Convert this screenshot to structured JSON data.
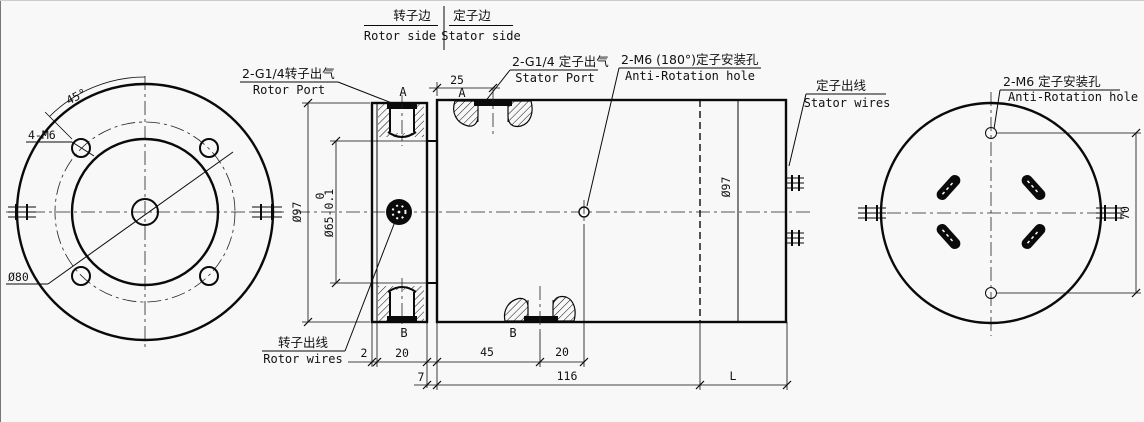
{
  "header": {
    "rotor_side_cn": "转子边",
    "rotor_side_en": "Rotor side",
    "stator_side_cn": "定子边",
    "stator_side_en": "Stator side"
  },
  "labels": {
    "rotor_port_cn": "2-G1/4转子出气",
    "rotor_port_en": "Rotor Port",
    "stator_port_cn": "2-G1/4 定子出气",
    "stator_port_en": "Stator Port",
    "anti_rotation_mid_cn": "2-M6 (180°)定子安装孔",
    "anti_rotation_mid_en": "Anti-Rotation hole",
    "stator_wires_cn": "定子出线",
    "stator_wires_en": "Stator wires",
    "anti_rotation_right_cn": "2-M6 定子安装孔",
    "anti_rotation_right_en": "Anti-Rotation hole",
    "rotor_wires_cn": "转子出线",
    "rotor_wires_en": "Rotor wires",
    "four_m6": "4-M6",
    "angle_45": "45°",
    "dia_80": "Ø80"
  },
  "dimensions": {
    "dia97_left": "Ø97",
    "dia65_tol_upper": "0",
    "dia65": "Ø65-0.1",
    "dia97_right": "Ø97",
    "top_25": "25",
    "bottom_2": "2",
    "bottom_20a": "20",
    "bottom_7": "7",
    "bottom_45": "45",
    "bottom_20b": "20",
    "bottom_116": "116",
    "bottom_L": "L",
    "right_70": "70"
  },
  "markers": {
    "a1": "A",
    "a2": "A",
    "b1": "B",
    "b2": "B"
  },
  "colors": {
    "line": "#0a0a0a",
    "background": "#f7f8f7"
  }
}
